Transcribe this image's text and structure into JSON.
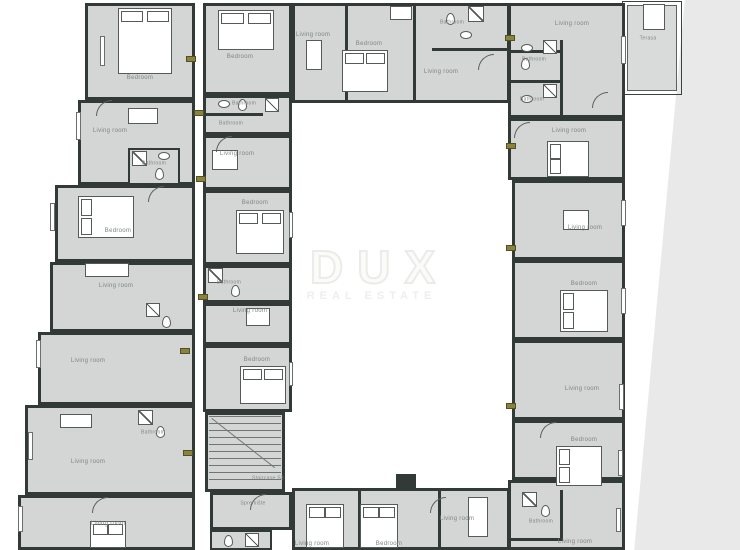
{
  "watermark": {
    "title": "DUX",
    "subtitle": "REAL ESTATE"
  },
  "colors": {
    "wall": "#323a37",
    "room_fill": "#d3d6d4",
    "terrace_fill": "#d8dbd9",
    "label_text": "#7f8583",
    "unit_tag": "#8a8240",
    "page_background": "#ffffff",
    "app_background": "#e9e9e9",
    "watermark": "#ecebe9"
  },
  "rooms": [
    {
      "label": "Bedroom"
    },
    {
      "label": "Living room"
    },
    {
      "label": "Bathroom"
    },
    {
      "label": "Bedroom"
    },
    {
      "label": "Living room"
    },
    {
      "label": "Living room"
    },
    {
      "label": "Living room"
    },
    {
      "label": "Bathroom"
    },
    {
      "label": "Living room"
    },
    {
      "label": "Bedroom"
    },
    {
      "label": "Bathroom"
    },
    {
      "label": "Bathroom"
    },
    {
      "label": "Living room"
    },
    {
      "label": "Bedroom"
    },
    {
      "label": "Bathroom"
    },
    {
      "label": "Living room"
    },
    {
      "label": "Bedroom"
    },
    {
      "label": "Staircase S3"
    },
    {
      "label": "Spremište"
    },
    {
      "label": "Living room"
    },
    {
      "label": "Bedroom"
    },
    {
      "label": "Bathroom"
    },
    {
      "label": "Living room"
    },
    {
      "label": "Living room"
    },
    {
      "label": "Terasa"
    },
    {
      "label": "Bathroom"
    },
    {
      "label": "Bathroom"
    },
    {
      "label": "Living room"
    },
    {
      "label": "Living room"
    },
    {
      "label": "Bedroom"
    },
    {
      "label": "Living room"
    },
    {
      "label": "Bedroom"
    },
    {
      "label": "Bathroom"
    },
    {
      "label": "Living room"
    },
    {
      "label": "Living room"
    },
    {
      "label": "Bedroom"
    },
    {
      "label": "Living room"
    }
  ]
}
